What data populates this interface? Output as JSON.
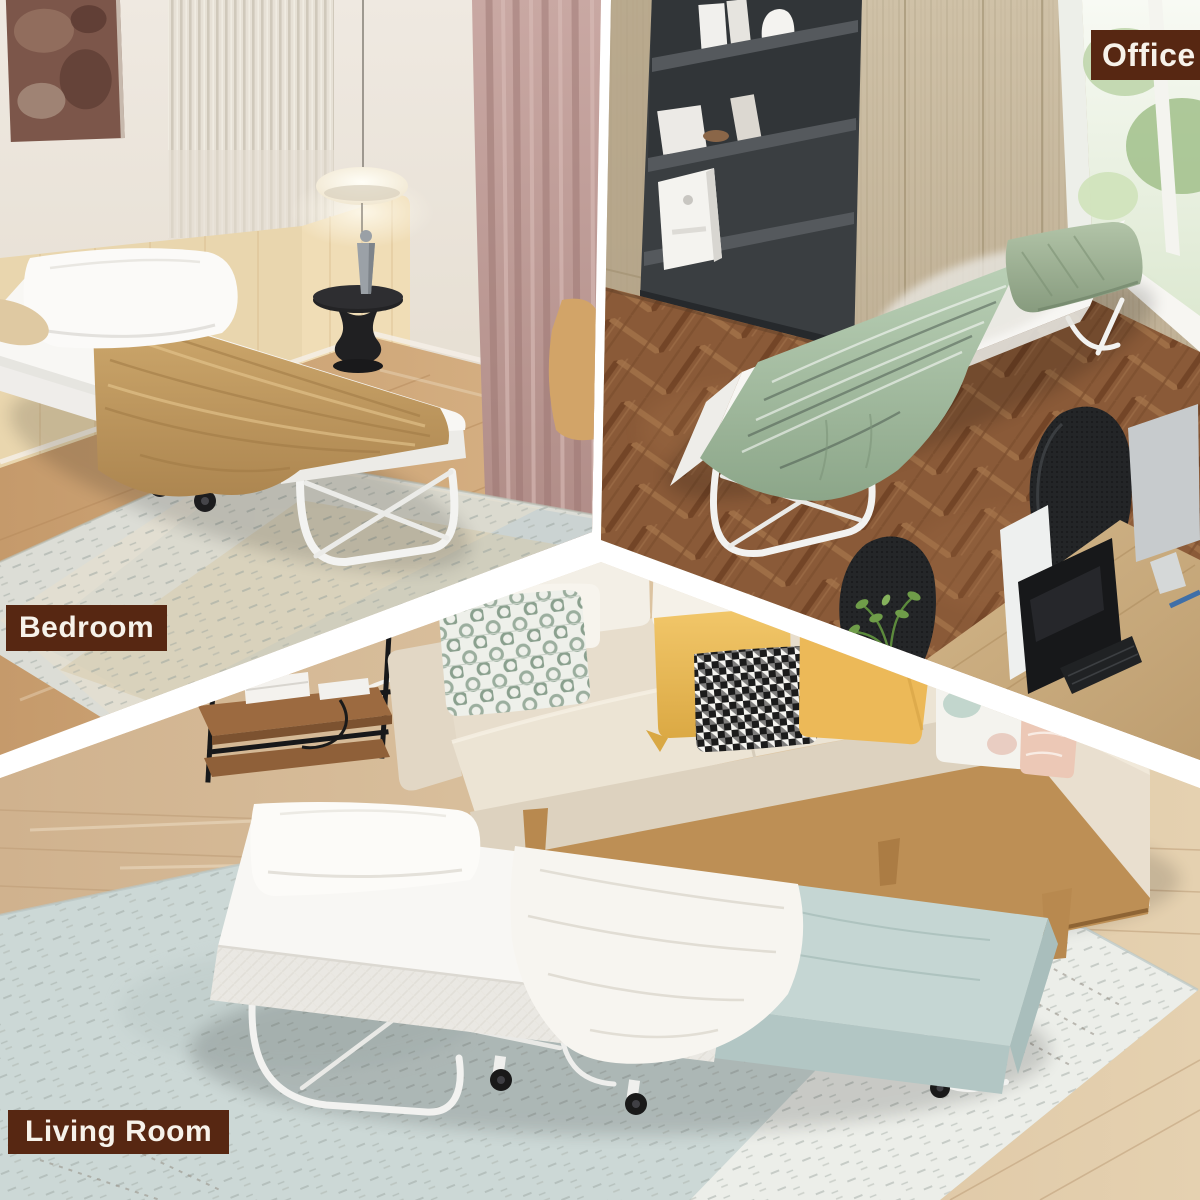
{
  "page": {
    "type": "product-photo-collage",
    "description": "Folding guest bed with mattress shown staged in three rooms, separated by white diagonal dividers"
  },
  "labels": {
    "bedroom": "Bedroom",
    "office": "Office",
    "living_room": "Living Room"
  },
  "label_style": {
    "background": "#572712",
    "text_color": "#f7f2ea"
  },
  "scenes": [
    {
      "id": "bedroom",
      "label": "Bedroom",
      "position": "top-left",
      "items": [
        "folding bed on casters",
        "white mattress",
        "white pillow",
        "tan blanket",
        "pendant globe lamp",
        "black pedestal side table",
        "grey figurine",
        "mauve curtains",
        "woven area rug",
        "abstract wall art",
        "slatted wall panel"
      ]
    },
    {
      "id": "office",
      "label": "Office",
      "position": "top-right",
      "items": [
        "folding bed on casters",
        "white mattress",
        "sage green pillow",
        "green striped blanket",
        "dark bookshelf with books",
        "wood cabinets",
        "bright window with greenery",
        "black mesh office chairs",
        "desks with monitors",
        "herringbone wood floor",
        "desk plant"
      ]
    },
    {
      "id": "living_room",
      "label": "Living Room",
      "position": "bottom",
      "items": [
        "folding bed on casters",
        "white mattress with pillow",
        "white throw blanket",
        "light blue folded mattress end",
        "beige three-seat sofa",
        "patterned, yellow, houndstooth, pastel and pink throw pillows",
        "black metal side table with wood shelves",
        "pale blue-grey area rug",
        "light wood floor"
      ]
    }
  ],
  "palette": {
    "divider": "#ffffff",
    "bedroom_wall": "#e9e3d9",
    "bedroom_curtain": "#bd9a95",
    "bedroom_blanket": "#c7a266",
    "office_cabinet": "#c5b79d",
    "office_floor": "#8a5a38",
    "office_blanket": "#a3bb9f",
    "sofa_beige": "#e7ddcc",
    "pillow_yellow": "#eec05e",
    "bed_teal": "#c3d4d1",
    "living_rug": "#cdd9d6",
    "living_floor": "#d2b694"
  }
}
